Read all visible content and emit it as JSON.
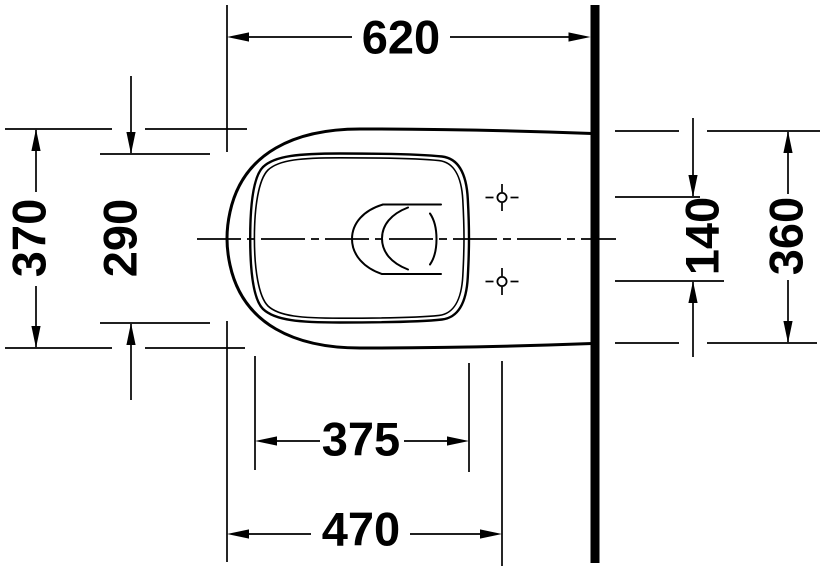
{
  "drawing": {
    "background_color": "#ffffff",
    "line_color": "#000000",
    "view": "plan",
    "dimensions": {
      "overall_length": {
        "label": "620"
      },
      "overall_width": {
        "label": "370"
      },
      "bowl_inner_width": {
        "label": "290"
      },
      "fixing_hole_spacing": {
        "label": "140"
      },
      "width_at_wall": {
        "label": "360"
      },
      "bowl_inner_length": {
        "label": "375"
      },
      "front_to_fixing_holes": {
        "label": "470"
      }
    }
  }
}
